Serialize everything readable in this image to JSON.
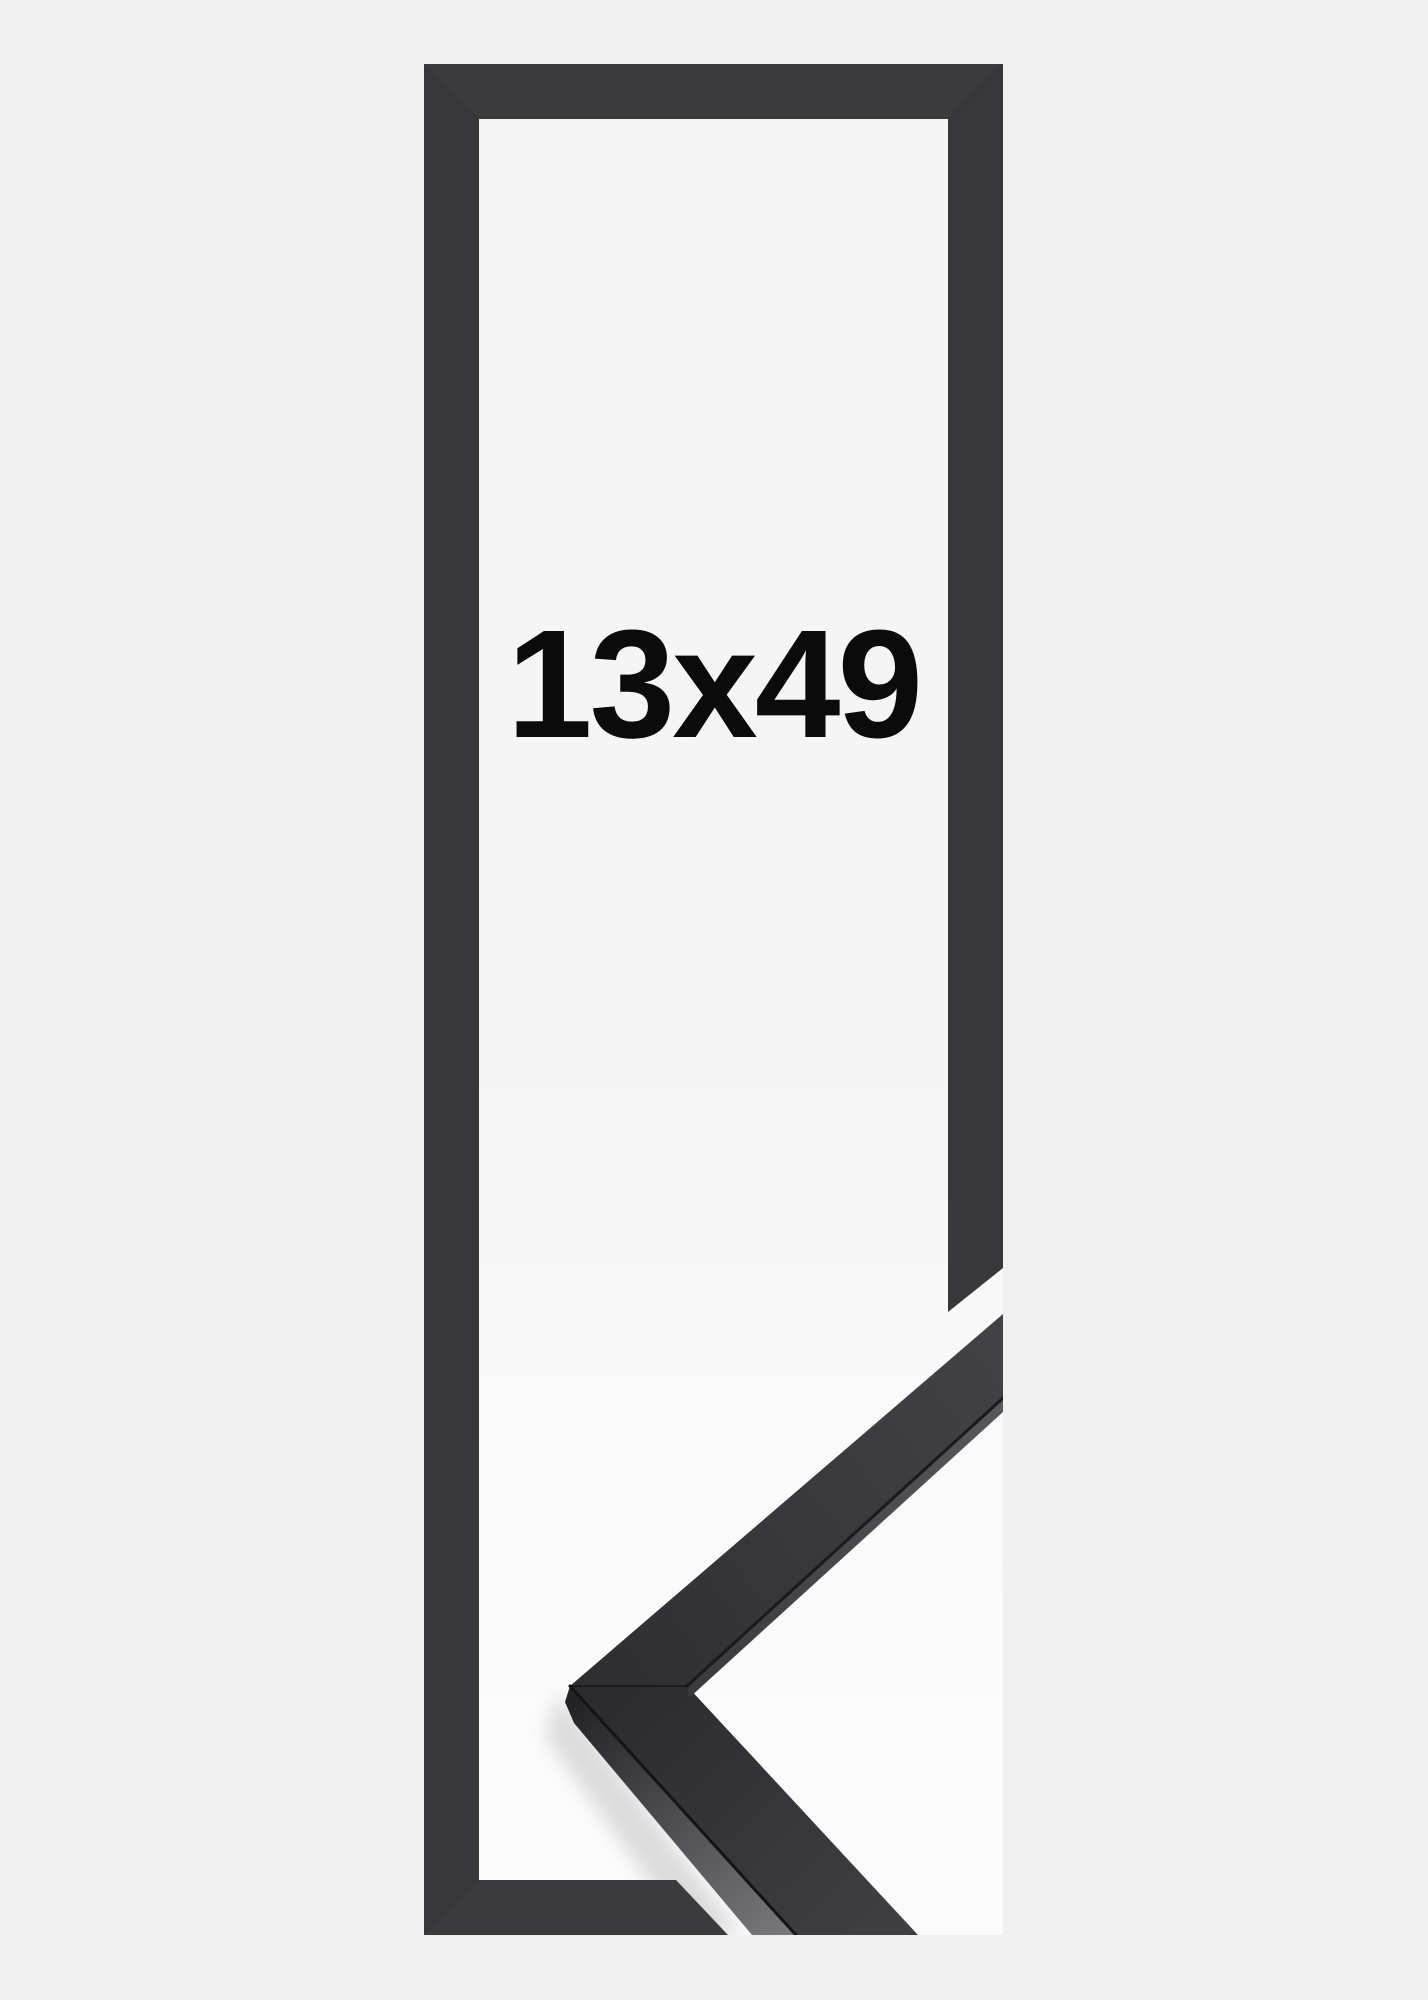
{
  "page": {
    "description": "Product image of a narrow black picture frame shown as a tall flat outline with a photographed 3D corner sample of the moulding at the lower right",
    "background_color": "#f0f0f1"
  },
  "frame_preview": {
    "size_label": "13x49",
    "colors": {
      "page-bg": "#f0f0f1",
      "photo-bg": "#f5f5f6",
      "frame-color": "#3b3b3e",
      "frame-color-2": "#38383b",
      "label-color": "#0b0b0b",
      "corner-top-face": "#333336",
      "corner-side-face-dark": "#232326",
      "corner-side-face-light": "#78787c"
    }
  }
}
